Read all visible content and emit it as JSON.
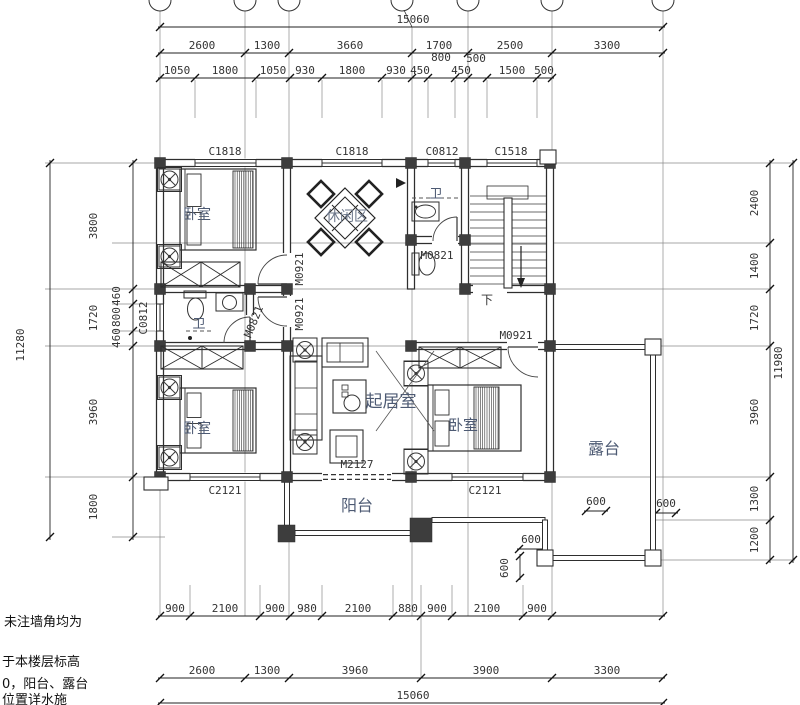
{
  "drawing": {
    "type": "floor-plan",
    "accent_color": "#2e2e2e",
    "label_color": "#4d5a73",
    "dim_color": "#333333"
  },
  "rooms": {
    "bedroom1": "卧室",
    "bedroom2": "卧室",
    "bedroom3": "卧室",
    "leisure": "休闲区",
    "bath_top": "卫",
    "bath_left": "卫",
    "living": "起居室",
    "balcony": "阳台",
    "terrace": "露台",
    "stair_down": "下"
  },
  "openings": {
    "c1818_a": "C1818",
    "c1818_b": "C1818",
    "c0812_top": "C0812",
    "c1518": "C1518",
    "c0812_left": "C0812",
    "c2121_left": "C2121",
    "c2121_right": "C2121",
    "m0921_a": "M0921",
    "m0921_b": "M0921",
    "m0921_c": "M0921",
    "m0821_left": "M0821",
    "m0821_top": "M0821",
    "m2127": "M2127"
  },
  "dims": {
    "top": {
      "overall": "15060",
      "row2": [
        "2600",
        "1300",
        "3660",
        "1700",
        "2500",
        "3300"
      ],
      "row2_sub": [
        "800",
        "500"
      ],
      "row3": [
        "1050",
        "1800",
        "1050",
        "930",
        "1800",
        "930",
        "450",
        "450",
        "1500",
        "500"
      ]
    },
    "bottom": {
      "row1": [
        "900",
        "2100",
        "900",
        "980",
        "2100",
        "880",
        "900",
        "2100",
        "900"
      ],
      "row2": [
        "2600",
        "1300",
        "3960",
        "3900",
        "3300"
      ],
      "overall": "15060"
    },
    "left": {
      "overall": "11280",
      "col": [
        "3800",
        "1720",
        "3960",
        "1800"
      ],
      "sub": [
        "460",
        "800",
        "460"
      ]
    },
    "right": {
      "overall": "11980",
      "col": [
        "2400",
        "1400",
        "1720",
        "3960",
        "1300",
        "1200"
      ]
    },
    "small": [
      "600",
      "600",
      "600",
      "600"
    ]
  },
  "notes": {
    "line1": "未注墙角均为",
    "line2": "于本楼层标高",
    "line3": "0，阳台、露台",
    "line4": "位置详水施"
  }
}
